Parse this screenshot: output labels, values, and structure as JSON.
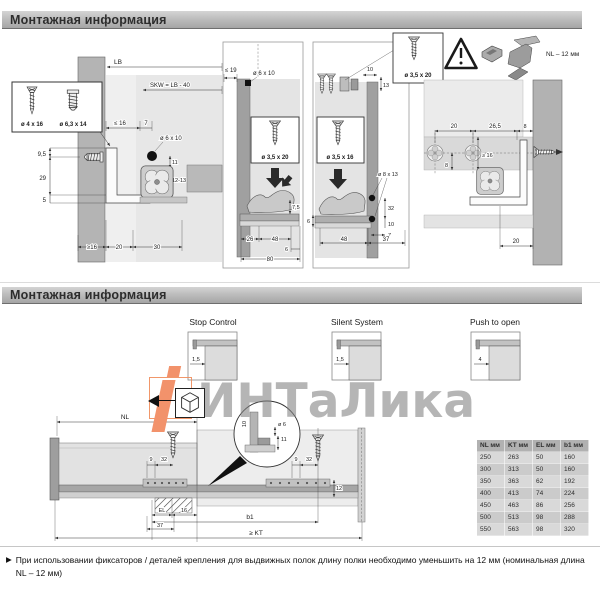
{
  "section1": {
    "header": "Монтажная информация",
    "screw_box": {
      "screw1": "ø 4 x 16",
      "screw2": "ø 6,3 x 14"
    },
    "left": {
      "lb": "LB",
      "skw": "SKW = LB - 40",
      "le16": "≤ 16",
      "d7": "7",
      "d6x10": "ø 6 x 10",
      "d11": "11",
      "d1213": "12-13",
      "d95": "9,5",
      "d29": "29",
      "d5": "5",
      "ge16": "≥16",
      "d20": "20",
      "d30": "30"
    },
    "panel1": {
      "le19": "≤ 19",
      "d6x10": "ø 6 x 10",
      "screw": "ø 3,5 x 20",
      "d75": "7,5",
      "d26": "26",
      "d48": "48",
      "d6": "6",
      "d80": "80"
    },
    "panel2": {
      "d10": "10",
      "d13": "13",
      "screw": "ø 3,5 x 16",
      "d8x13": "ø 8 x 13",
      "d32": "32",
      "d10b": "10",
      "d7": "7",
      "d6": "6",
      "d48": "48",
      "d37": "37"
    },
    "top_right": {
      "screw": "ø 3,5 x 20",
      "nl12": "NL – 12 мм"
    },
    "right": {
      "d20": "20",
      "d265": "26,5",
      "d8": "8",
      "d8v": "8",
      "ge16": "≥ 16",
      "d20b": "20"
    }
  },
  "section2": {
    "header": "Монтажная информация",
    "diagrams": [
      {
        "label": "Stop Control",
        "dim": "1,5"
      },
      {
        "label": "Silent System",
        "dim": "1,5"
      },
      {
        "label": "Push to open",
        "dim": "4"
      }
    ],
    "drawing": {
      "nl": "NL",
      "d9": "9",
      "d32": "32",
      "d12": "12",
      "det10": "10",
      "det6": "ø 6",
      "det11": "11",
      "el": "EL",
      "d37": "37",
      "d16": "16",
      "b1": "b1",
      "kt": "≥ KT"
    },
    "table": {
      "headers": [
        "NL мм",
        "KT мм",
        "EL мм",
        "b1 мм"
      ],
      "rows": [
        [
          "250",
          "263",
          "50",
          "160"
        ],
        [
          "300",
          "313",
          "50",
          "160"
        ],
        [
          "350",
          "363",
          "62",
          "192"
        ],
        [
          "400",
          "413",
          "74",
          "224"
        ],
        [
          "450",
          "463",
          "86",
          "256"
        ],
        [
          "500",
          "513",
          "98",
          "288"
        ],
        [
          "550",
          "563",
          "98",
          "320"
        ]
      ]
    }
  },
  "watermark": {
    "text": "ИНТаЛика"
  },
  "note": {
    "bullet": "▶",
    "text": "При использовании фиксаторов / деталей крепления для выдвижных полок длину полки необходимо уменьшить на 12 мм (номинальная длина NL – 12 мм)"
  },
  "colors": {
    "accent_orange": "#f2926b",
    "watermark_gray": "#808080",
    "bar_top": "#d4d4d4",
    "bar_bottom": "#a5a5a5"
  }
}
